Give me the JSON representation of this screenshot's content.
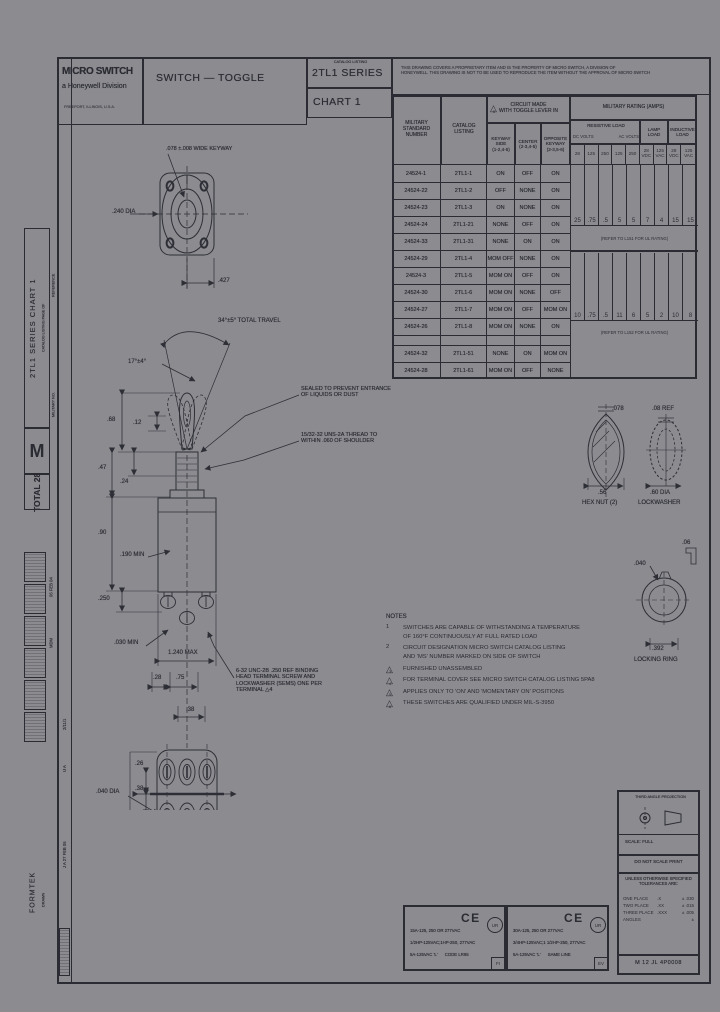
{
  "header": {
    "brand": "MICRO SWITCH",
    "brand_sub": "a Honeywell Division",
    "brand_addr": "FREEPORT, ILLINOIS, U.S.A.",
    "doc_title": "SWITCH — TOGGLE",
    "catalog_label": "CATALOG LISTING",
    "series": "2TL1 SERIES",
    "chart": "CHART 1",
    "proprietary": "THIS DRAWING COVERS A PROPRIETARY ITEM AND IS THE PROPERTY OF MICRO SWITCH, A DIVISION OF\nHONEYWELL. THIS DRAWING IS NOT TO BE USED TO REPRODUCE THE ITEM WITHOUT THE APPROVAL OF MICRO SWITCH"
  },
  "table": {
    "ms_header": "MILITARY\nSTANDARD\nNUMBER",
    "listing_header": "CATALOG\nLISTING",
    "circuit_header": "CIRCUIT MADE\nWITH TOGGLE LEVER IN",
    "circuit_flag": "5",
    "sub_headers": [
      "KEYWAY\nSIDE\n(1-2,4-5)",
      "CENTER\n(2-3,4-5)",
      "OPPOSITE\nKEYWAY\n(2-3,5-6)"
    ],
    "rows": [
      {
        "ms": "24524-1",
        "cat": "2TL1-1",
        "keyway": "ON",
        "center": "OFF",
        "opposite": "ON"
      },
      {
        "ms": "24524-22",
        "cat": "2TL1-2",
        "keyway": "OFF",
        "center": "NONE",
        "opposite": "ON"
      },
      {
        "ms": "24524-23",
        "cat": "2TL1-3",
        "keyway": "ON",
        "center": "NONE",
        "opposite": "ON"
      },
      {
        "ms": "24524-24",
        "cat": "2TL1-21",
        "keyway": "NONE",
        "center": "OFF",
        "opposite": "ON"
      },
      {
        "ms": "24524-33",
        "cat": "2TL1-31",
        "keyway": "NONE",
        "center": "ON",
        "opposite": "ON"
      },
      {
        "ms": "24524-29",
        "cat": "2TL1-4",
        "keyway": "MOM OFF",
        "center": "NONE",
        "opposite": "ON"
      },
      {
        "ms": "24524-3",
        "cat": "2TL1-5",
        "keyway": "MOM ON",
        "center": "OFF",
        "opposite": "ON"
      },
      {
        "ms": "24524-30",
        "cat": "2TL1-6",
        "keyway": "MOM ON",
        "center": "NONE",
        "opposite": "OFF"
      },
      {
        "ms": "24524-27",
        "cat": "2TL1-7",
        "keyway": "MOM ON",
        "center": "OFF",
        "opposite": "MOM ON"
      },
      {
        "ms": "24524-26",
        "cat": "2TL1-8",
        "keyway": "MOM ON",
        "center": "NONE",
        "opposite": "ON"
      },
      {
        "blank": true
      },
      {
        "ms": "24524-32",
        "cat": "2TL1-51",
        "keyway": "NONE",
        "center": "ON",
        "opposite": "MOM ON"
      },
      {
        "ms": "24524-28",
        "cat": "2TL1-61",
        "keyway": "MOM ON",
        "center": "OFF",
        "opposite": "NONE"
      }
    ],
    "ratings": {
      "title": "MILITARY RATING (AMPS)",
      "resistive": "RESISTIVE LOAD",
      "resistive_sub_left": "DC VOLTS",
      "resistive_sub_right": "AC VOLTS",
      "lamp": "LAMP\nLOAD",
      "inductive": "INDUCTIVE\nLOAD",
      "volt_cells": [
        "28",
        "125",
        "250",
        "125",
        "250",
        "28\nVDC",
        "125\nVAC",
        "28\nVDC",
        "125\nVAC"
      ],
      "amps_group1": [
        "25",
        ".75",
        ".5",
        "5",
        "5",
        "7",
        "4",
        "15",
        "15"
      ],
      "amps_group2": [
        "10",
        ".75",
        ".5",
        "11",
        "6",
        "5",
        "2",
        "10",
        "8"
      ],
      "note1": "(REFER TO L151 FOR UL RATING)",
      "note2": "(REFER TO L152 FOR UL RATING)"
    }
  },
  "drawing": {
    "keyway_note": ".078 ±.008 WIDE KEYWAY",
    "dia240": ".240 DIA",
    "d427": ".427",
    "travel": "34°±5° TOTAL TRAVEL",
    "half_travel": "17°±4°",
    "seal_note": "SEALED TO PREVENT ENTRANCE\nOF LIQUIDS OR DUST",
    "thread_note": "15/32-32 UNS-2A THREAD TO\nWITHIN .060 OF SHOULDER",
    "d68": ".68",
    "d12": ".12",
    "d47": ".47",
    "d24": ".24",
    "d90": ".90",
    "d190": ".190 MIN",
    "d250": ".250",
    "d030": ".030 MIN",
    "d124max": "1.240 MAX",
    "d28": ".28",
    "d75": ".75",
    "d38": ".38",
    "screw_note": "6-32 UNC-2B .250 REF BINDING\nHEAD TERMINAL SCREW AND\nLOCKWASHER (SEMS) ONE PER\nTERMINAL  △4",
    "t26": ".26",
    "t38": ".38",
    "t040": ".040 DIA",
    "hex_078": ".078",
    "hex_56": ".56",
    "hex_label": "HEX NUT (2)",
    "lw_ref": ".08 REF",
    "lw_dia": ".60 DIA",
    "lw_label": "LOCKWASHER",
    "lr_06": ".06",
    "lr_040": ".040",
    "lr_392": ".392",
    "lr_label": "LOCKING RING"
  },
  "notes": {
    "title": "NOTES",
    "items": [
      {
        "num": "1",
        "flag": false,
        "text": "SWITCHES ARE CAPABLE OF WITHSTANDING A TEMPERATURE\nOF 160°F CONTINUOUSLY AT FULL RATED LOAD"
      },
      {
        "num": "2",
        "flag": false,
        "text": "CIRCUIT DESIGNATION MICRO SWITCH CATALOG LISTING\nAND 'MS' NUMBER MARKED ON SIDE OF SWITCH"
      },
      {
        "num": "3",
        "flag": true,
        "text": "FURNISHED UNASSEMBLED"
      },
      {
        "num": "4",
        "flag": true,
        "text": "FOR TERMINAL COVER SEE MICRO SWITCH CATALOG LISTING 5PA8"
      },
      {
        "num": "5",
        "flag": true,
        "text": "APPLIES ONLY TO 'ON' AND 'MOMENTARY ON' POSITIONS"
      },
      {
        "num": "6",
        "flag": true,
        "text": "THESE SWITCHES ARE QUALIFIED UNDER MIL-S-3950"
      }
    ]
  },
  "stamps": {
    "ce": "CE",
    "cert_mark": "UR",
    "left": {
      "lines": [
        "15A-125, 250 OR 277VAC",
        "1/2HP-125VAC;1HP-250, 277VAC",
        "5A-125VAC 'L'      CODE LR95"
      ],
      "corner": "FI"
    },
    "right": {
      "lines": [
        "30A-125, 250 OR 277VAC",
        "3/4HP-125VAC;1 1/2HP-250, 277VAC",
        "5A-125VAC 'L'      SAME LINE"
      ],
      "corner": "EV"
    }
  },
  "titleblock": {
    "projection": "THIRD ANGLE PROJECTION",
    "scale": "SCALE:  FULL",
    "do_not": "DO NOT SCALE PRINT",
    "tol_title": "UNLESS OTHERWISE SPECIFIED\nTOLERANCES ARE:",
    "tol_rows": [
      [
        "ONE PLACE",
        ".X",
        "± .030"
      ],
      [
        "TWO PLACE",
        ".XX",
        "± .015"
      ],
      [
        "THREE PLACE",
        ".XXX",
        "± .005"
      ],
      [
        "ANGLES",
        "",
        "±"
      ]
    ],
    "doc_no": "M  12 JL 4P0008"
  },
  "sidebar": {
    "vertical_title_big": "2TL1 SERIES  CHART 1",
    "vertical_title_small": "CATALOG LISTING        PAGE      OF",
    "m": "M",
    "total": "TOTAL  28",
    "reference": "REFERENCE",
    "military_no": "MILITARY NO.",
    "formtek": "FORMTEK",
    "drawn": "DRAWN",
    "rev1": "J A 27 FEB 06",
    "rev2": "2/11/1",
    "rev3": "U A",
    "stamp_initials": "MDM",
    "stamp_date": "06 FEB 04"
  }
}
